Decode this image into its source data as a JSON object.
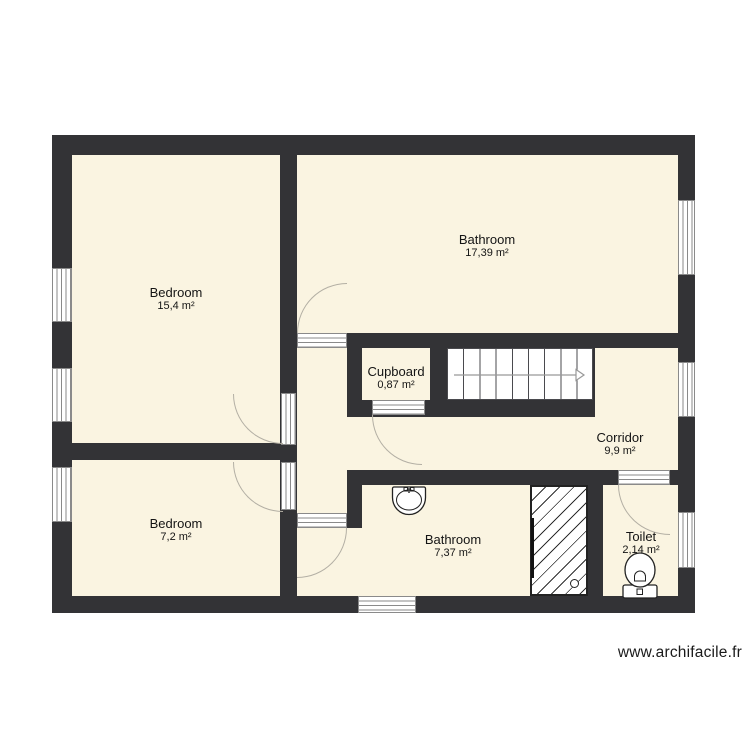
{
  "plan": {
    "watermark": "www.archifacile.fr",
    "rooms": {
      "bedroom1": {
        "name": "Bedroom",
        "area": "15,4 m²"
      },
      "bathroom1": {
        "name": "Bathroom",
        "area": "17,39 m²"
      },
      "cupboard": {
        "name": "Cupboard",
        "area": "0,87 m²"
      },
      "corridor": {
        "name": "Corridor",
        "area": "9,9 m²"
      },
      "bedroom2": {
        "name": "Bedroom",
        "area": "7,2 m²"
      },
      "bathroom2": {
        "name": "Bathroom",
        "area": "7,37 m²"
      },
      "toilet": {
        "name": "Toilet",
        "area": "2,14 m²"
      }
    },
    "colors": {
      "wall": "#333336",
      "floor": "#FAF4E1",
      "background": "#FFFFFF"
    },
    "fixtures": {
      "stairs": "staircase-up-arrow-right",
      "shower": "hatched-shower-tray",
      "sink": "washbasin",
      "toilet_fixture": "toilet-seat-with-cistern"
    }
  }
}
